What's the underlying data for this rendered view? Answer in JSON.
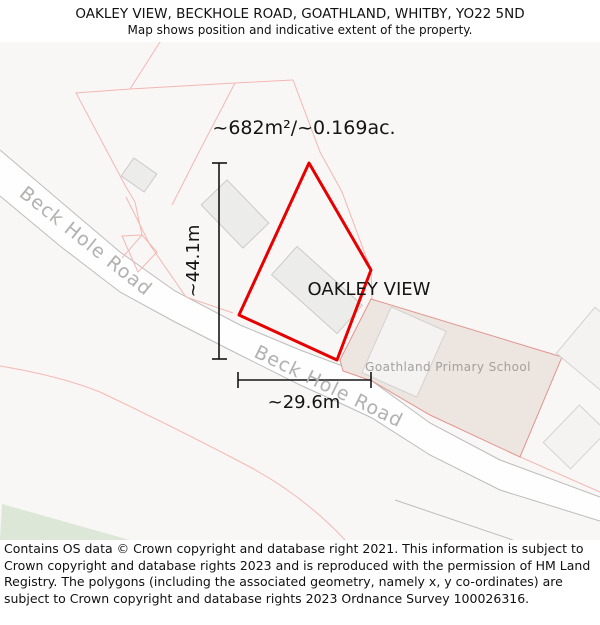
{
  "header": {
    "title": "OAKLEY VIEW, BECKHOLE ROAD, GOATHLAND, WHITBY, YO22 5ND",
    "subtitle": "Map shows position and indicative extent of the property."
  },
  "map": {
    "area_label": "~682m²/~0.169ac.",
    "property_label": "OAKLEY VIEW",
    "school_label": "Goathland Primary School",
    "road_label_1": "Beck Hole Road",
    "road_label_2": "Beck Hole Road",
    "dim_vertical_label": "~44.1m",
    "dim_horizontal_label": "~29.6m",
    "colors": {
      "property_outline": "#e60000",
      "parcel_line": "#f4b7b2",
      "school_fill": "#ece5e0",
      "school_outline": "#e2948d",
      "road_edge": "#bcbcbc",
      "building_fill": "#ececeb",
      "green_area": "#dde7d7",
      "road_label": "#b3b1af",
      "school_label": "#a3a09e"
    }
  },
  "footer": {
    "text": "Contains OS data © Crown copyright and database right 2021. This information is subject to Crown copyright and database rights 2023 and is reproduced with the permission of HM Land Registry. The polygons (including the associated geometry, namely x, y co-ordinates) are subject to Crown copyright and database rights 2023 Ordnance Survey 100026316."
  }
}
